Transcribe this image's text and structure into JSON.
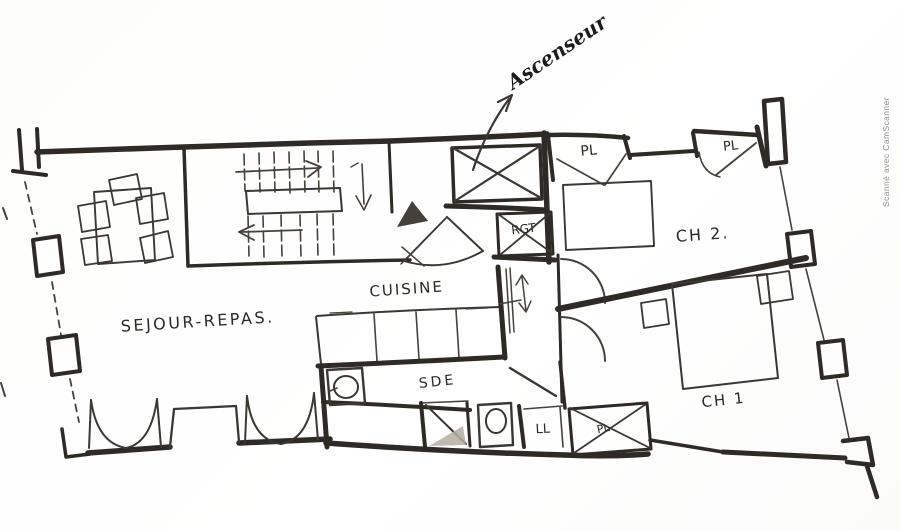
{
  "annotations": {
    "elevator_note": "Ascenseur",
    "scanner_watermark": "Scanné avec CamScanner"
  },
  "rooms": {
    "living_dining": "SEJOUR-REPAS.",
    "kitchen": "CUISINE",
    "shower_room": "SDE",
    "bedroom_2": "CH 2.",
    "bedroom_1": "CH 1"
  },
  "fixtures": {
    "closet_top_left": "PL",
    "closet_top_right": "PL",
    "closet_bedroom_1": "PL",
    "storage_unit": "RGT",
    "washing_machine": "LL"
  },
  "colors": {
    "paper": "#fdfdfc",
    "ink": "#2e2a25",
    "ink_light": "#46413b",
    "shade_fill": "#b5ada1",
    "watermark": "#8e8e8e"
  }
}
